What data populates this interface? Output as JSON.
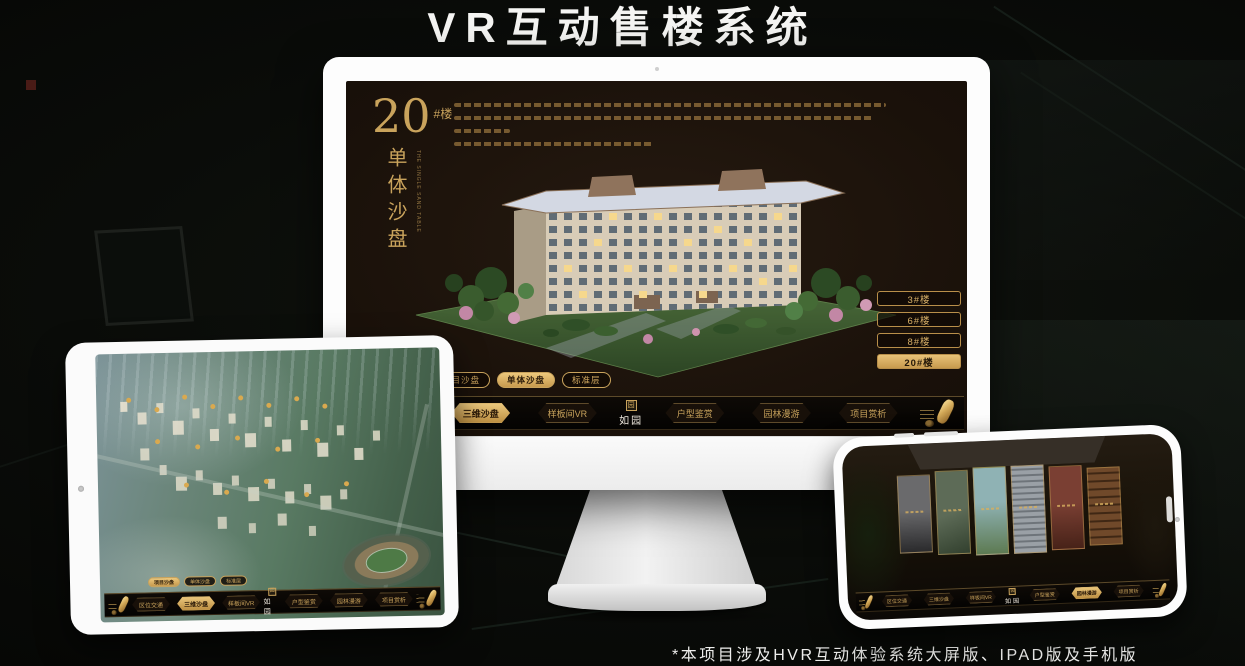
{
  "header": {
    "title": "VR互动售楼系统"
  },
  "footer": {
    "note": "*本项目涉及HVR互动体验系统大屏版、IPAD版及手机版"
  },
  "colors": {
    "gold": "#C9A35C",
    "gold_active": "#E3BD6E",
    "screen_bg": "#1B120A",
    "device_white": "#FBFBFB"
  },
  "monitor": {
    "headline": {
      "number": "20",
      "unit": "#楼",
      "vertical": "单体沙盘",
      "english": "THE SINGLE SAND TABLE"
    },
    "floor_buttons": [
      {
        "label": "3#楼",
        "active": false
      },
      {
        "label": "6#楼",
        "active": false
      },
      {
        "label": "8#楼",
        "active": false
      },
      {
        "label": "20#楼",
        "active": true
      }
    ],
    "tabs": [
      {
        "label": "项目沙盘",
        "active": false
      },
      {
        "label": "单体沙盘",
        "active": true
      },
      {
        "label": "标准层",
        "active": false
      }
    ],
    "nav": {
      "seal": "园",
      "logo": "如园",
      "items": [
        {
          "label": "区位交通",
          "active": false
        },
        {
          "label": "三维沙盘",
          "active": true
        },
        {
          "label": "样板间VR",
          "active": false
        },
        {
          "label": "户型鉴赏",
          "active": false
        },
        {
          "label": "园林漫游",
          "active": false
        },
        {
          "label": "项目赏析",
          "active": false
        }
      ]
    }
  },
  "ipad": {
    "tabs": [
      {
        "label": "项目沙盘",
        "active": true
      },
      {
        "label": "单体沙盘",
        "active": false
      },
      {
        "label": "标准层",
        "active": false
      }
    ],
    "nav": {
      "seal": "园",
      "logo": "如园",
      "items": [
        {
          "label": "区位交通",
          "active": false
        },
        {
          "label": "三维沙盘",
          "active": true
        },
        {
          "label": "样板间VR",
          "active": false
        },
        {
          "label": "户型鉴赏",
          "active": false
        },
        {
          "label": "园林漫游",
          "active": false
        },
        {
          "label": "项目赏析",
          "active": false
        }
      ]
    }
  },
  "phone": {
    "nav": {
      "seal": "园",
      "logo": "如园",
      "items": [
        {
          "label": "区位交通",
          "active": false
        },
        {
          "label": "三维沙盘",
          "active": false
        },
        {
          "label": "样板间VR",
          "active": false
        },
        {
          "label": "户型鉴赏",
          "active": false
        },
        {
          "label": "园林漫游",
          "active": true
        },
        {
          "label": "项目赏析",
          "active": false
        }
      ]
    }
  }
}
